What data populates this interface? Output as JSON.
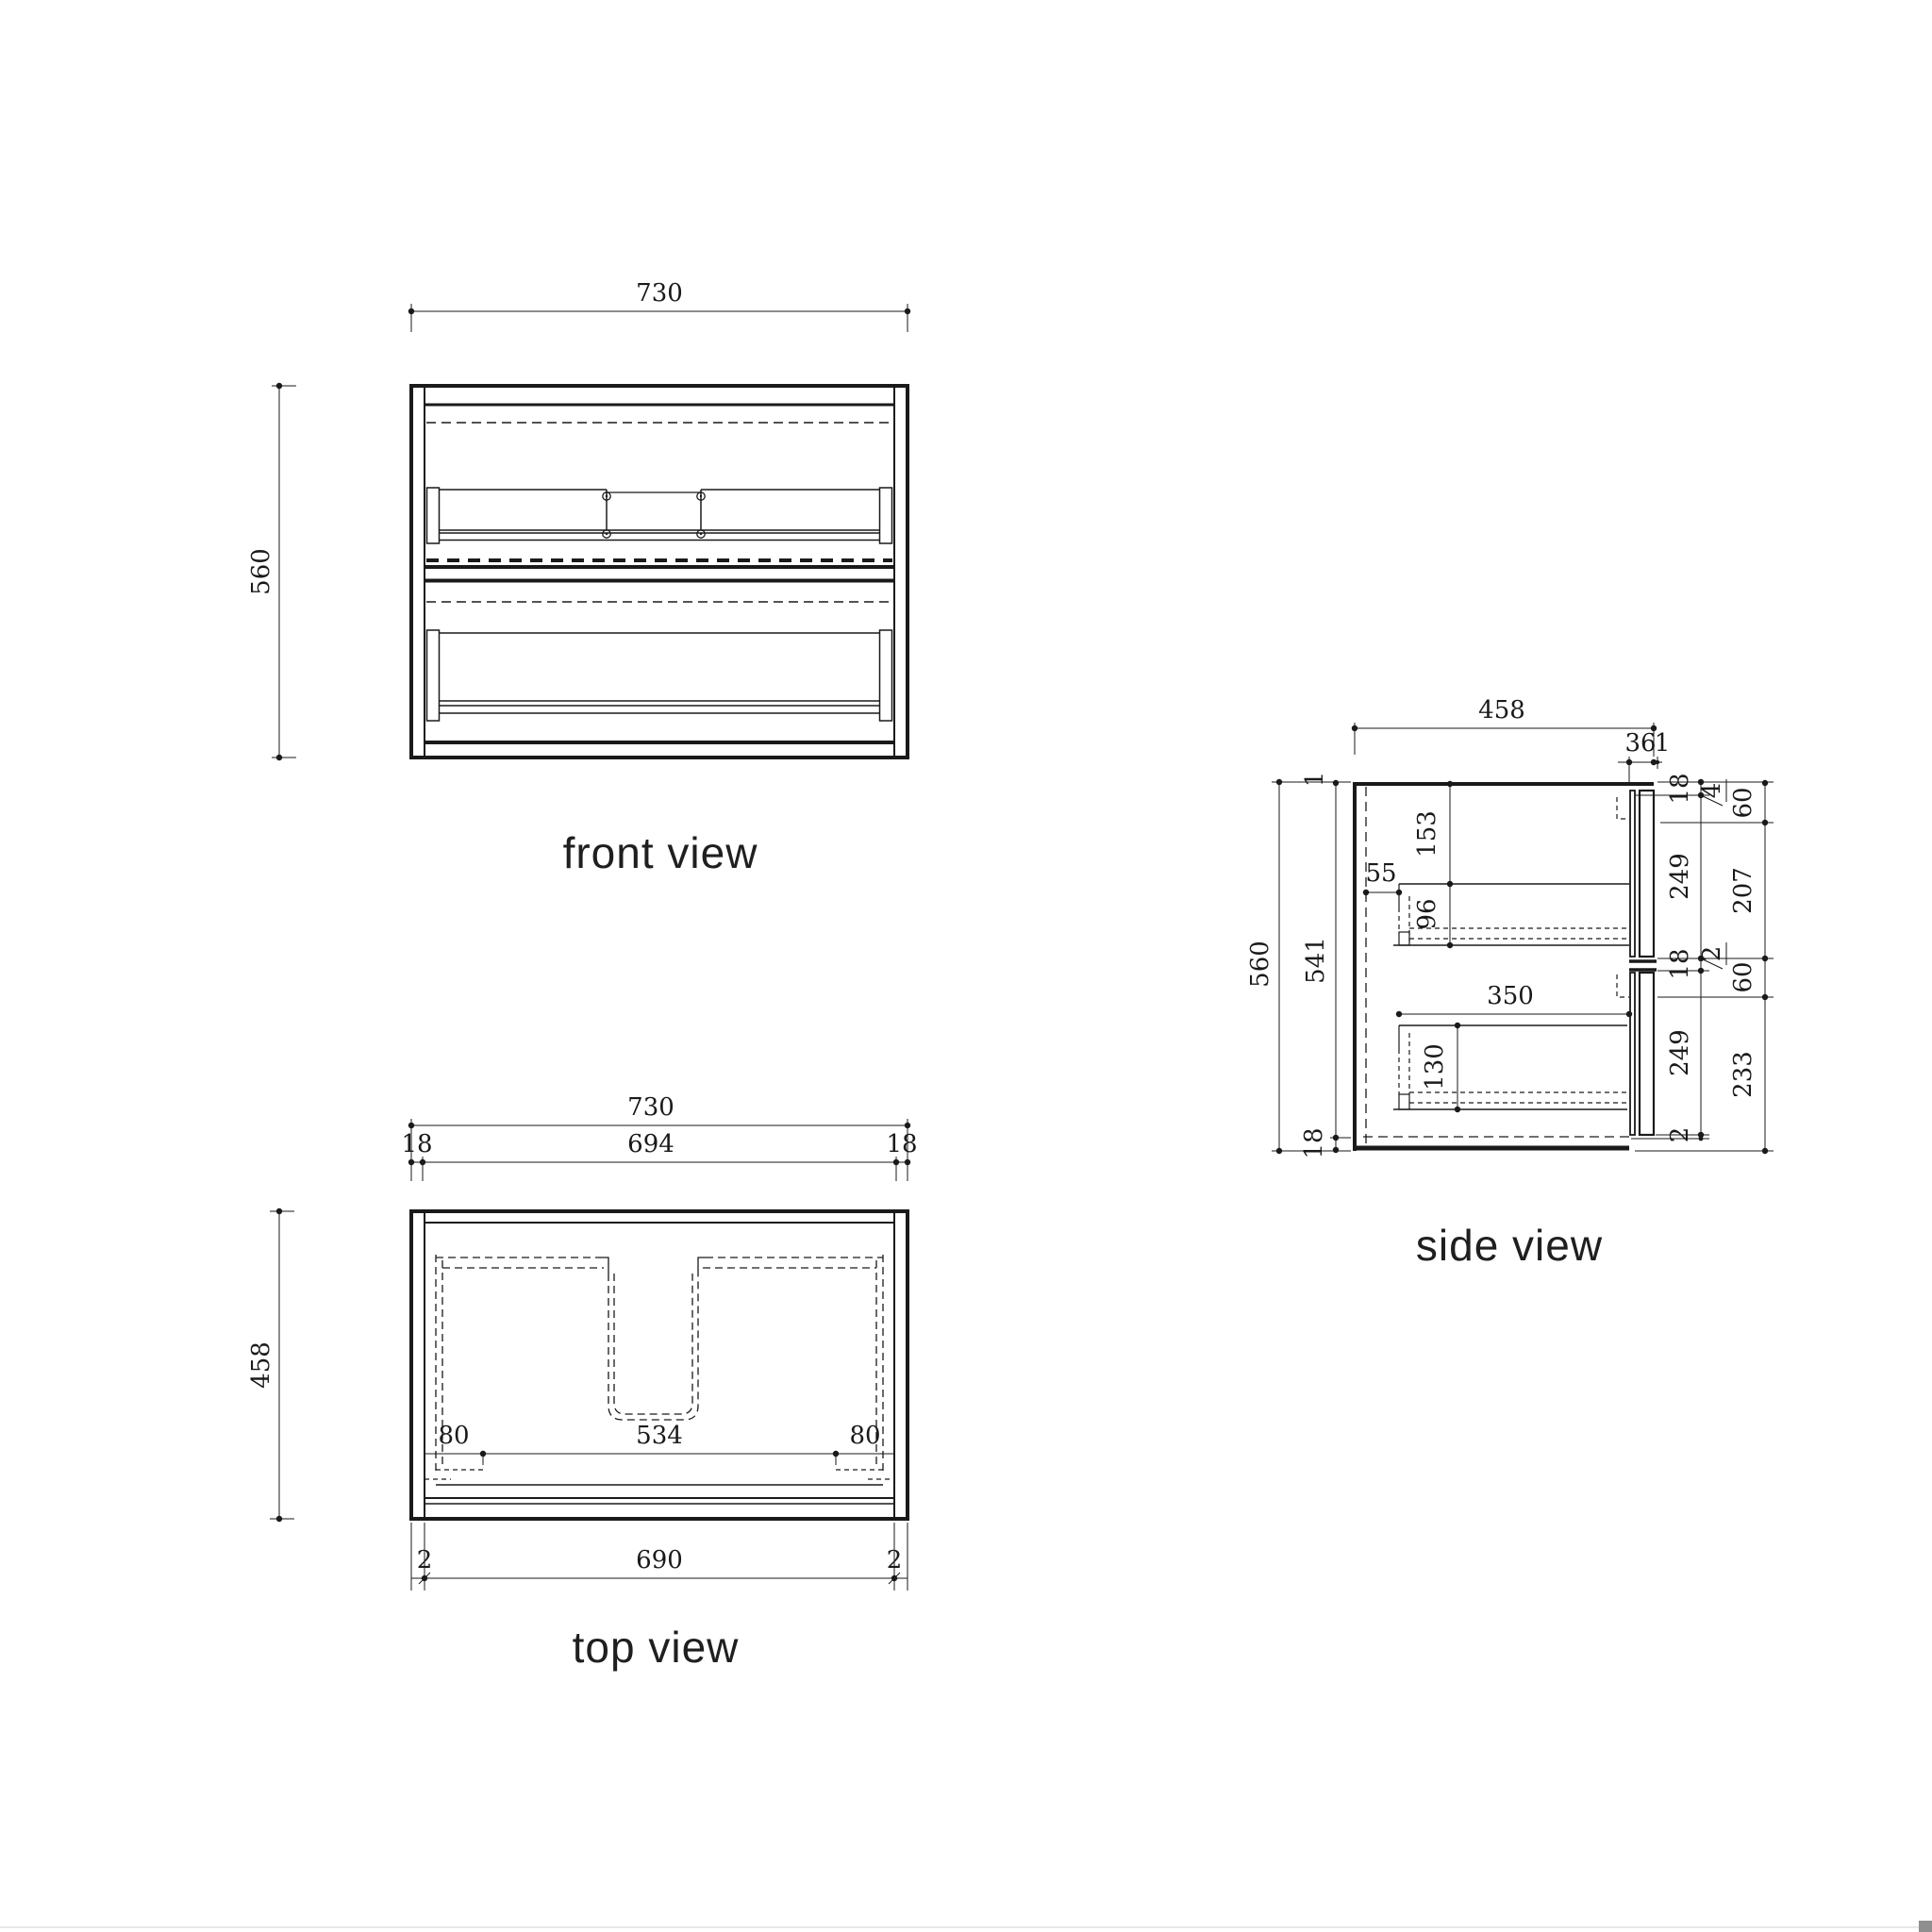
{
  "colors": {
    "ink": "#1a1a1a",
    "label": "#1f1f1f",
    "paper": "#ffffff",
    "edge_line": "#e7e7e7",
    "corner_box": "#8f8f8f"
  },
  "front": {
    "label": "front view",
    "width": "730",
    "height": "560"
  },
  "top": {
    "label": "top view",
    "width": "730",
    "inner_width": "694",
    "side_l": "18",
    "side_r": "18",
    "depth": "458",
    "off_l": "80",
    "basin": "534",
    "off_r": "80",
    "bottom": "690",
    "edge_l": "2",
    "edge_r": "2"
  },
  "side": {
    "label": "side view",
    "depth": "458",
    "front_t": "36",
    "front_gap": "1",
    "height": "560",
    "inner_h": "541",
    "top_gap": "1",
    "bottom_t": "18",
    "d1_top": "153",
    "d1_back": "55",
    "d1_h": "96",
    "d2_len": "350",
    "d2_h": "130",
    "rA1": "18",
    "rA2": "249",
    "rA3": "18",
    "rA4": "249",
    "rA5": "2",
    "flag4": "4",
    "flag2": "2",
    "rC1": "60",
    "rC2": "207",
    "rC3": "60",
    "rC4": "233"
  }
}
